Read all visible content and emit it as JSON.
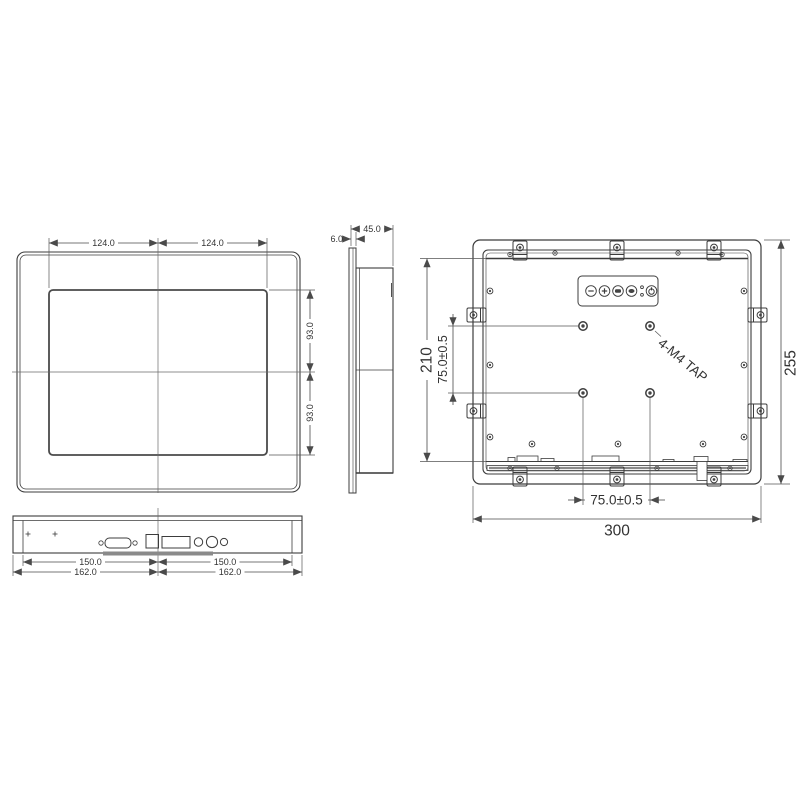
{
  "drawing": {
    "front_view": {
      "dim_half_width_left": "124.0",
      "dim_half_width_right": "124.0",
      "dim_half_height_upper": "93.0",
      "dim_half_height_lower": "93.0"
    },
    "side_view": {
      "dim_depth": "45.0",
      "dim_bezel_thickness": "6.0"
    },
    "rear_view": {
      "dim_inner_height": "210",
      "dim_overall_height": "255",
      "dim_overall_width": "300",
      "dim_vesa_vertical": "75.0±0.5",
      "dim_vesa_horizontal": "75.0±0.5",
      "vesa_tap_label": "4-M4 TAP",
      "osd_button_icons": [
        "minus-icon",
        "plus-icon",
        "menu-icon",
        "select-icon",
        "power-icon"
      ],
      "osd_led_count": 2
    },
    "bottom_view": {
      "dim_connector_span_left": "150.0",
      "dim_connector_span_right": "150.0",
      "dim_body_width_left": "162.0",
      "dim_body_width_right": "162.0"
    }
  },
  "colors": {
    "line": "#3c3c3c",
    "dim_line": "#4a4a4a",
    "text": "#333333",
    "background": "#ffffff"
  }
}
